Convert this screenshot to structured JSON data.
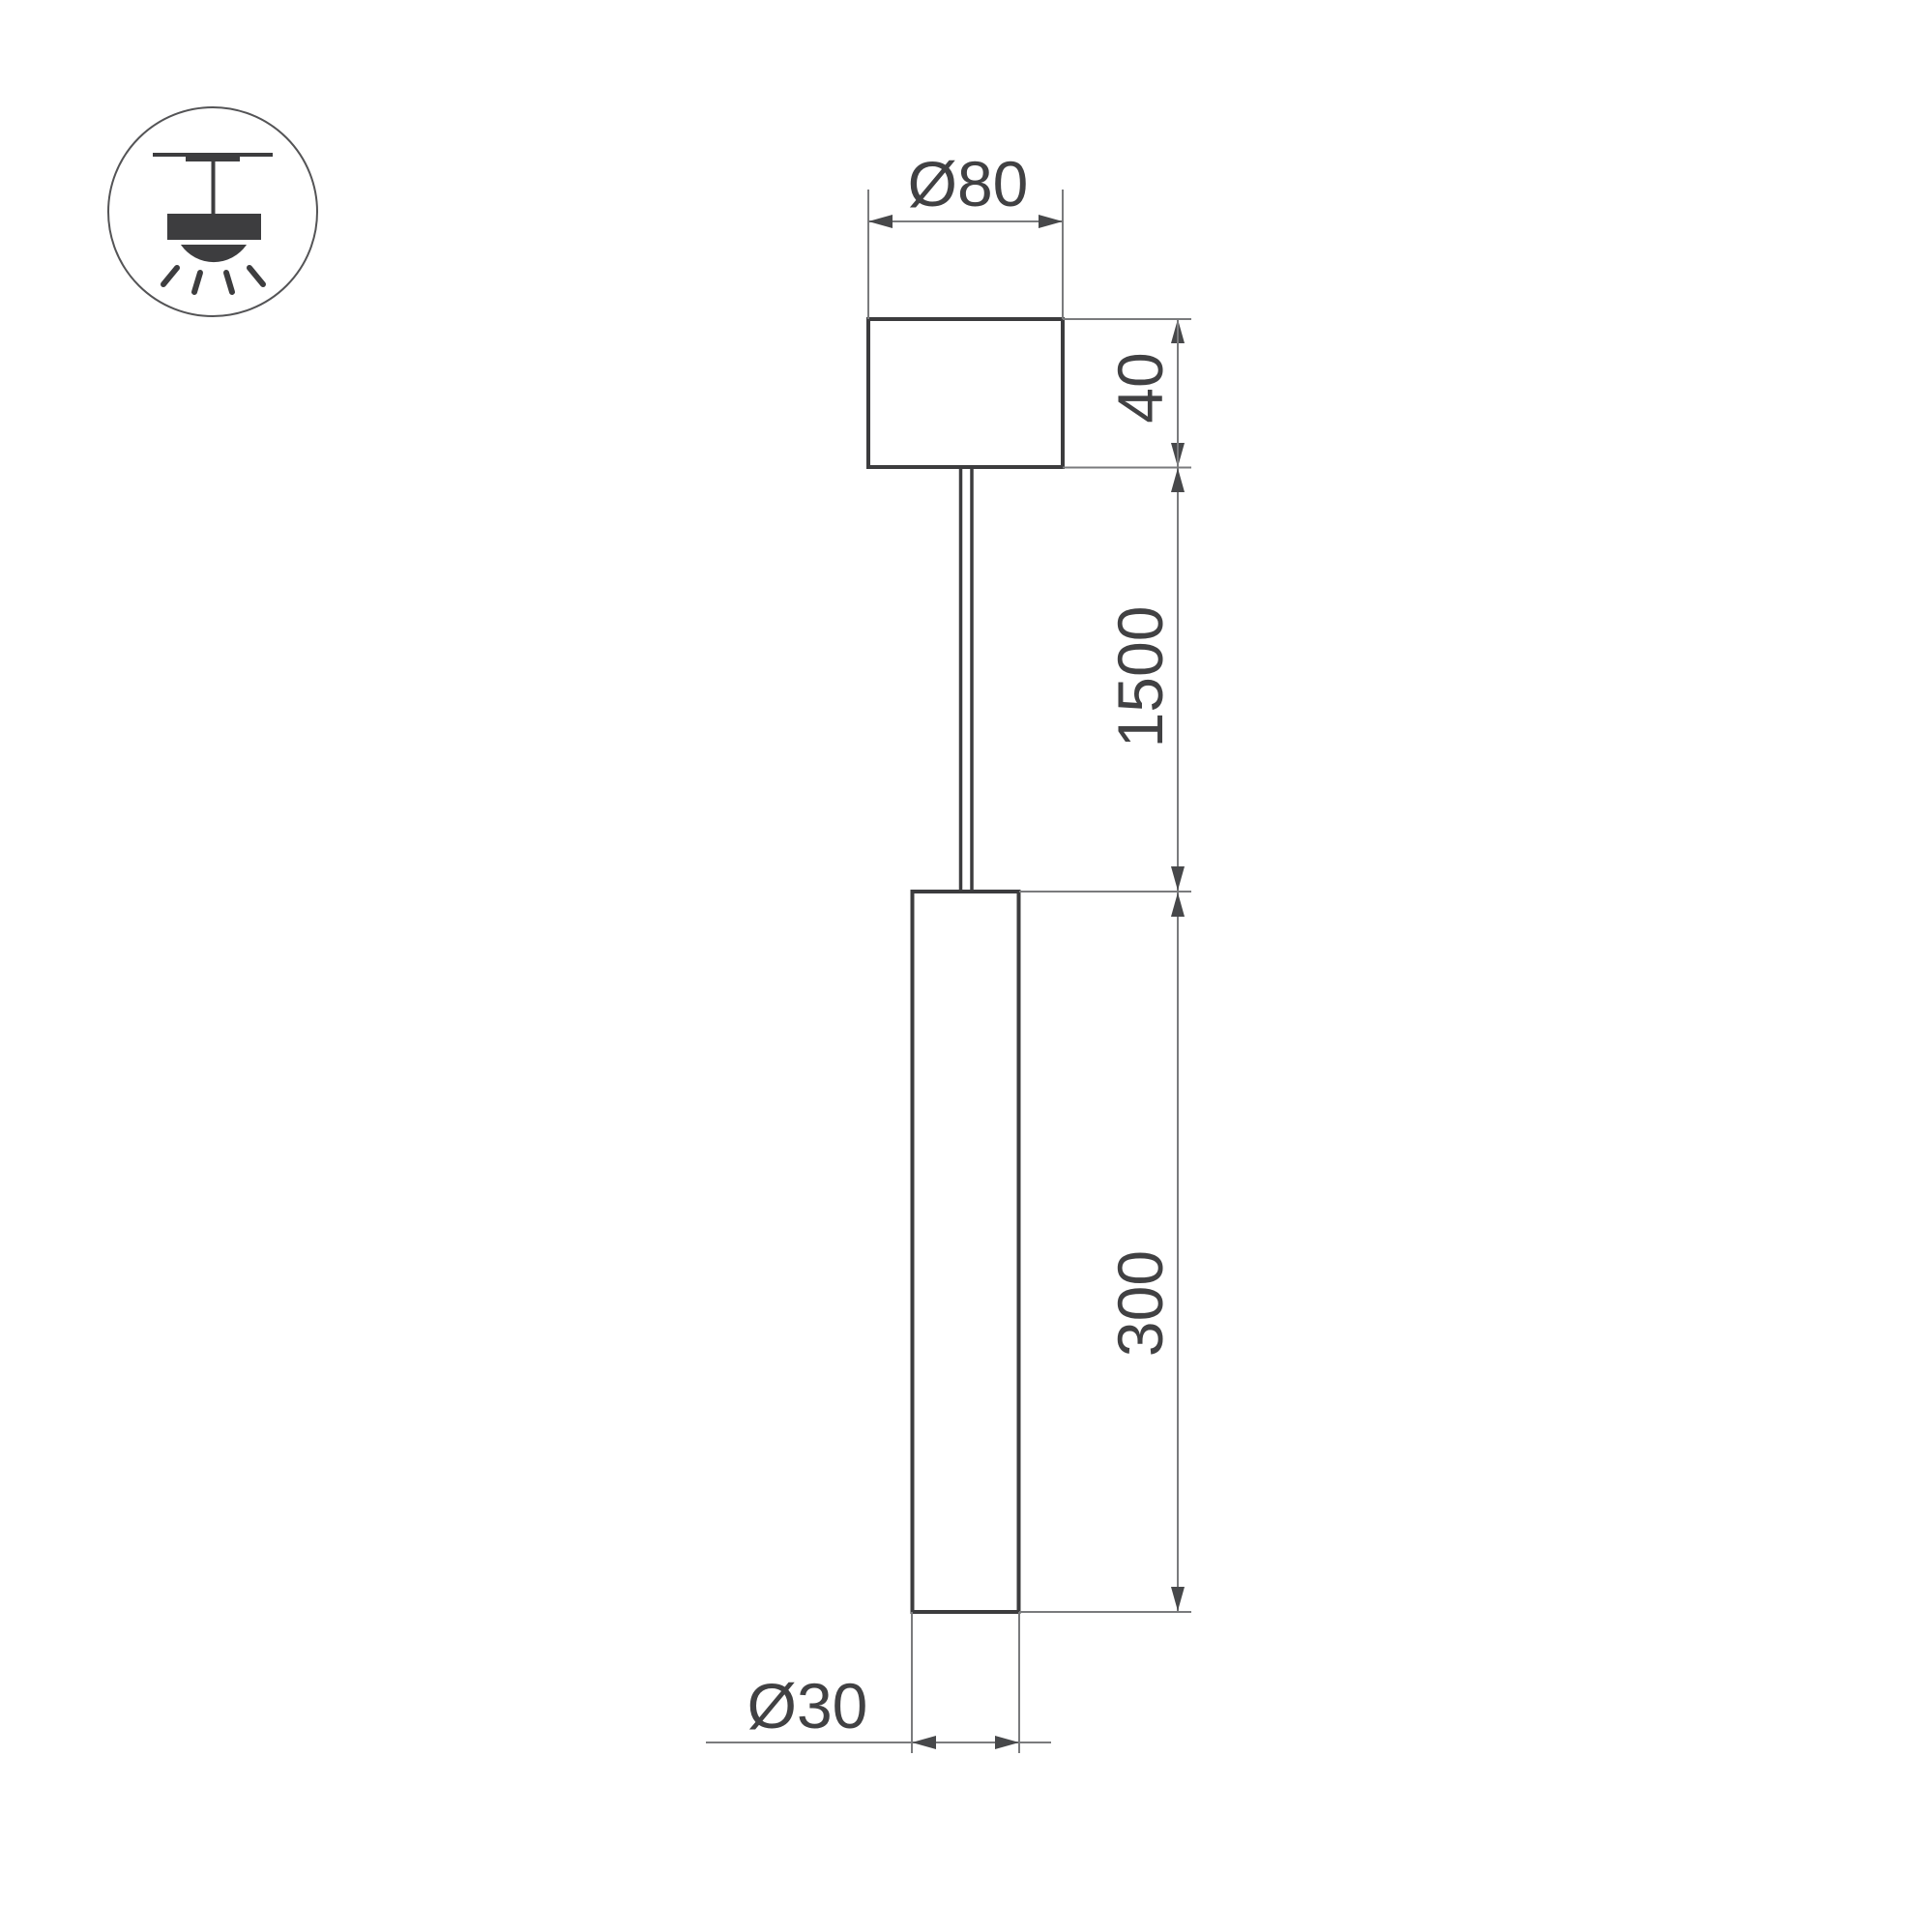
{
  "icon": {
    "name": "ceiling-pendant-light-icon"
  },
  "labels": {
    "canopy_diameter": "Ø80",
    "canopy_height": "40",
    "suspension_length": "1500",
    "tube_length": "300",
    "tube_diameter": "Ø30"
  },
  "colors": {
    "background": "#ffffff",
    "object_line": "#3c3c3e",
    "dimension_line": "#7a7b7d",
    "arrow_fill": "#47484a",
    "label_text": "#414143",
    "icon_fill": "#3d3d3f",
    "icon_circle_stroke": "#545456"
  }
}
